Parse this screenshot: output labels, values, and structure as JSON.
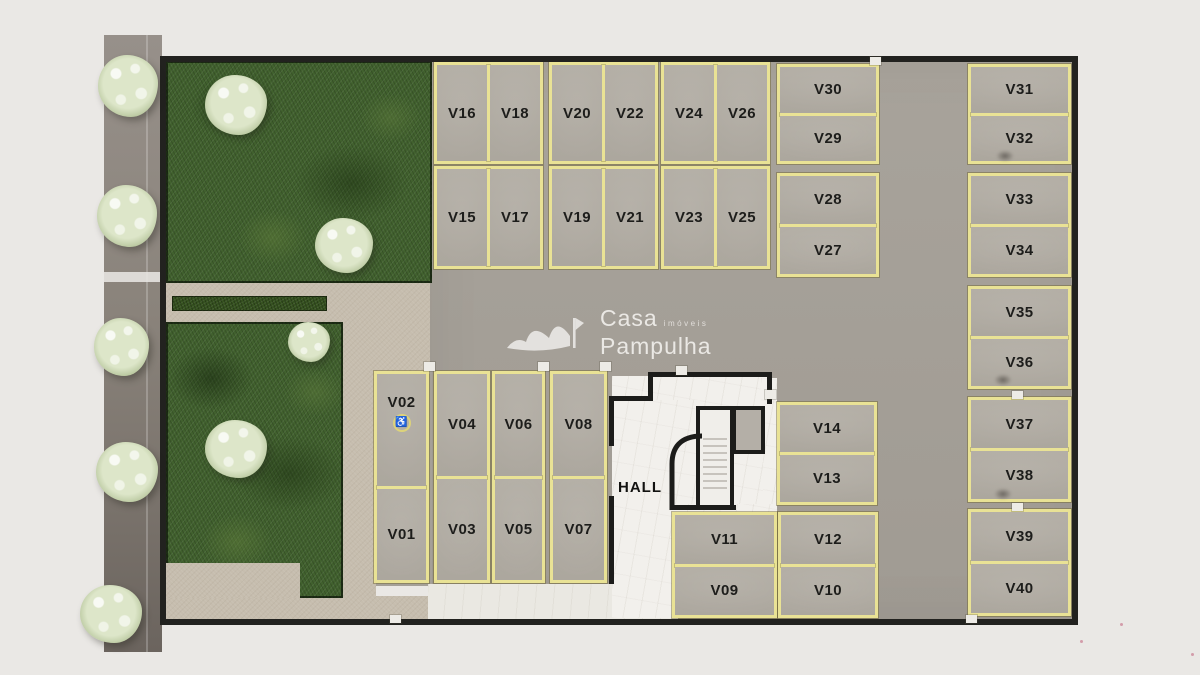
{
  "logo": {
    "name": "Casa",
    "tagline": "imóveis",
    "name2": "Pampulha"
  },
  "hall_label": "HALL",
  "parking": {
    "accessible_symbol": "♿",
    "accessible_space": "V02",
    "labels": {
      "V01": "V01",
      "V02": "V02",
      "V03": "V03",
      "V04": "V04",
      "V05": "V05",
      "V06": "V06",
      "V07": "V07",
      "V08": "V08",
      "V09": "V09",
      "V10": "V10",
      "V11": "V11",
      "V12": "V12",
      "V13": "V13",
      "V14": "V14",
      "V15": "V15",
      "V16": "V16",
      "V17": "V17",
      "V18": "V18",
      "V19": "V19",
      "V20": "V20",
      "V21": "V21",
      "V22": "V22",
      "V23": "V23",
      "V24": "V24",
      "V25": "V25",
      "V26": "V26",
      "V27": "V27",
      "V28": "V28",
      "V29": "V29",
      "V30": "V30",
      "V31": "V31",
      "V32": "V32",
      "V33": "V33",
      "V34": "V34",
      "V35": "V35",
      "V36": "V36",
      "V37": "V37",
      "V38": "V38",
      "V39": "V39",
      "V40": "V40"
    }
  },
  "colors": {
    "stall_line_yellow": "#e9e295",
    "asphalt": "#a5a098",
    "grass": "#41612e",
    "path_beige": "#c6bdae",
    "wall_black": "#1c1c1a",
    "hall_floor": "#f2f0ec",
    "background": "#eae8e5"
  }
}
